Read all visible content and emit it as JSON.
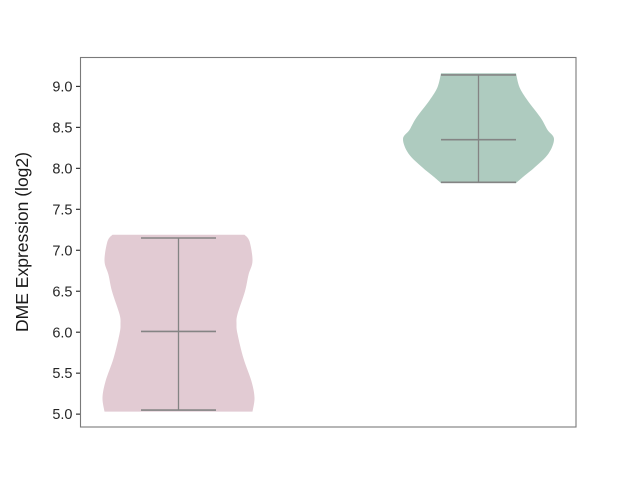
{
  "chart_data": {
    "type": "violin",
    "title": "",
    "xlabel": "",
    "ylabel": "DME Expression (log2)",
    "ytick_labels": [
      "5.0",
      "5.5",
      "6.0",
      "6.5",
      "7.0",
      "7.5",
      "8.0",
      "8.5",
      "9.0"
    ],
    "ylim": [
      4.843,
      9.353
    ],
    "grid": false,
    "legend": "none",
    "frame_color": "#7a7a7a",
    "tick_color": "#333333",
    "text_color": "#262626",
    "inner_line_color": "#848484",
    "series": [
      {
        "name": "violin-low",
        "fill_color": "#e2cbd3",
        "median": 6.01,
        "whisker_min": 5.05,
        "whisker_max": 7.15,
        "center_x_px": 178.5,
        "cap_halfwidth_px": 37.5,
        "profile": [
          [
            7.19,
            66
          ],
          [
            7.11,
            71
          ],
          [
            6.87,
            74
          ],
          [
            6.7,
            70
          ],
          [
            6.5,
            66.5
          ],
          [
            6.22,
            59
          ],
          [
            6.1,
            58
          ],
          [
            5.98,
            59
          ],
          [
            5.68,
            65
          ],
          [
            5.4,
            73
          ],
          [
            5.2,
            76
          ],
          [
            5.03,
            74
          ]
        ]
      },
      {
        "name": "violin-high",
        "fill_color": "#aecbbf",
        "median": 8.35,
        "whisker_min": 7.83,
        "whisker_max": 9.14,
        "center_x_px": 478.5,
        "cap_halfwidth_px": 37.5,
        "profile": [
          [
            9.16,
            37.5
          ],
          [
            8.99,
            41
          ],
          [
            8.83,
            49
          ],
          [
            8.62,
            62
          ],
          [
            8.47,
            69
          ],
          [
            8.36,
            75.5
          ],
          [
            8.18,
            70
          ],
          [
            8.01,
            56
          ],
          [
            7.89,
            44
          ],
          [
            7.82,
            37.5
          ]
        ]
      }
    ]
  }
}
